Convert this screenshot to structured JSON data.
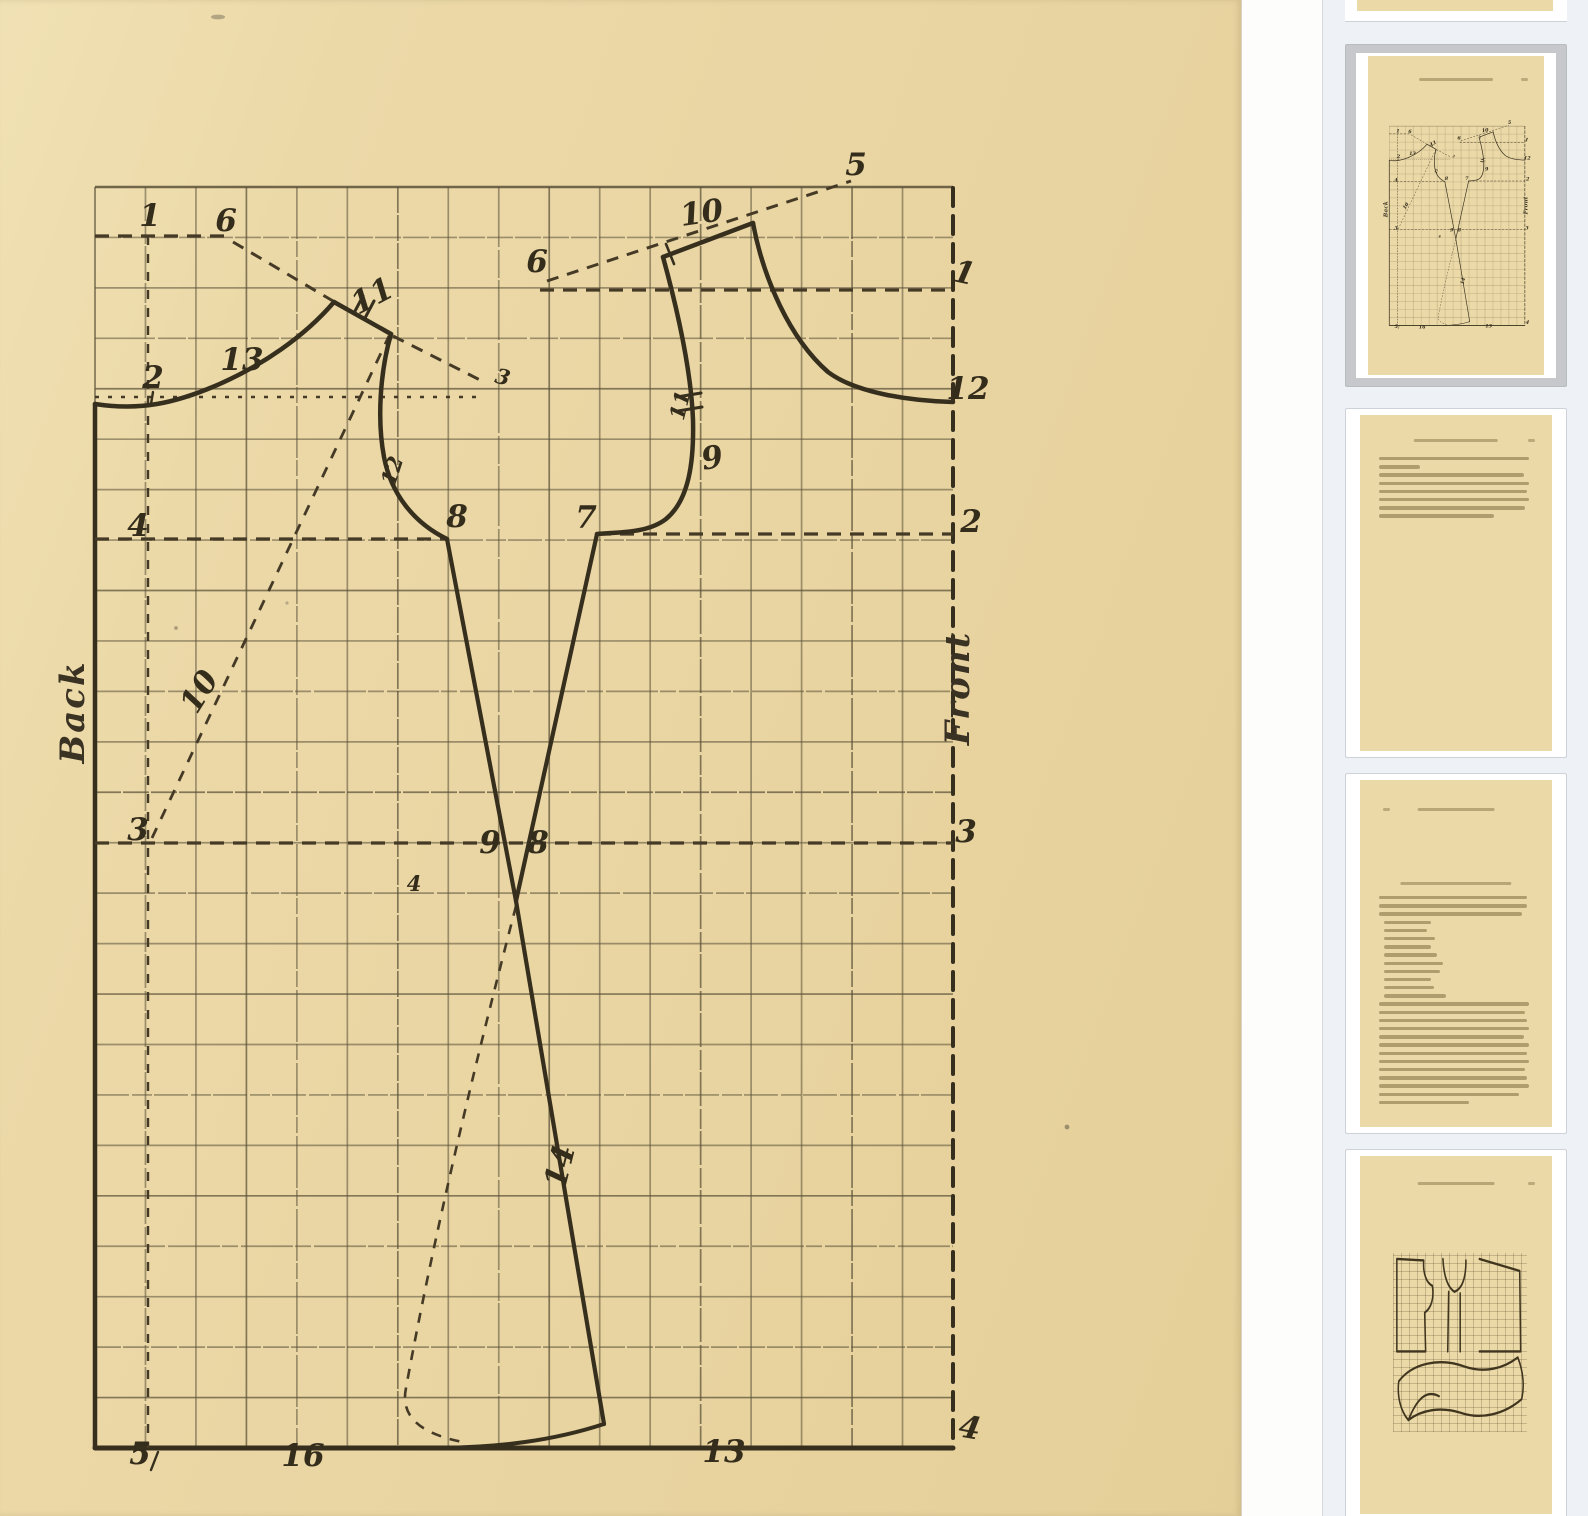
{
  "app": {
    "description": "book reader with thumbnail pane showing a garment drafting diagram page"
  },
  "main_page": {
    "side_labels": {
      "back": "Back",
      "front": "Front"
    },
    "diagram": {
      "grid": {
        "cols": 17,
        "rows": 25,
        "x0": 95,
        "y0": 187,
        "x1": 953,
        "y1": 1448
      },
      "point_labels": [
        {
          "t": "1",
          "x": 150,
          "y": 226,
          "r": 0
        },
        {
          "t": "6",
          "x": 226,
          "y": 231,
          "r": 0
        },
        {
          "t": "5",
          "x": 856,
          "y": 175,
          "r": 0
        },
        {
          "t": "10",
          "x": 703,
          "y": 223,
          "r": -8
        },
        {
          "t": "6",
          "x": 537,
          "y": 272,
          "r": 0
        },
        {
          "t": "1",
          "x": 962,
          "y": 283,
          "r": 12
        },
        {
          "t": "12",
          "x": 968,
          "y": 399,
          "r": 0
        },
        {
          "t": "13",
          "x": 242,
          "y": 370,
          "r": 0
        },
        {
          "t": "2",
          "x": 153,
          "y": 388,
          "r": 0
        },
        {
          "t": "11",
          "x": 377,
          "y": 305,
          "r": -28
        },
        {
          "t": "3",
          "x": 501,
          "y": 384,
          "r": 14,
          "small": true
        },
        {
          "t": "12",
          "x": 399,
          "y": 473,
          "r": -72,
          "small": true
        },
        {
          "t": "4",
          "x": 138,
          "y": 536,
          "r": 0
        },
        {
          "t": "8",
          "x": 457,
          "y": 527,
          "r": 0
        },
        {
          "t": "7",
          "x": 586,
          "y": 528,
          "r": 0
        },
        {
          "t": "2",
          "x": 971,
          "y": 532,
          "r": 0
        },
        {
          "t": "9",
          "x": 714,
          "y": 468,
          "r": -10
        },
        {
          "t": "11",
          "x": 687,
          "y": 407,
          "r": -76,
          "small": true
        },
        {
          "t": "10",
          "x": 208,
          "y": 697,
          "r": -58
        },
        {
          "t": "3",
          "x": 138,
          "y": 840,
          "r": 0
        },
        {
          "t": "3",
          "x": 966,
          "y": 842,
          "r": 0
        },
        {
          "t": "9",
          "x": 490,
          "y": 853,
          "r": 0
        },
        {
          "t": "8",
          "x": 538,
          "y": 853,
          "r": 0
        },
        {
          "t": "14",
          "x": 570,
          "y": 1169,
          "r": -76
        },
        {
          "t": "4",
          "x": 414,
          "y": 891,
          "r": 0,
          "small": true
        },
        {
          "t": "5",
          "x": 140,
          "y": 1464,
          "r": 0
        },
        {
          "t": "16",
          "x": 303,
          "y": 1466,
          "r": 0
        },
        {
          "t": "13",
          "x": 724,
          "y": 1462,
          "r": 0
        },
        {
          "t": "4",
          "x": 968,
          "y": 1438,
          "r": 10
        }
      ]
    }
  },
  "sidebar": {
    "thumbnails": [
      {
        "kind": "page-bottom-partial",
        "selected": false
      },
      {
        "kind": "diagram-gown-draft",
        "selected": true
      },
      {
        "kind": "text-page",
        "selected": false,
        "text_lines": [
          96,
          26,
          93,
          96,
          95,
          96,
          94,
          74
        ]
      },
      {
        "kind": "text-measurements-page",
        "selected": false,
        "para1": [
          95,
          95,
          92
        ],
        "list_lines": [
          30,
          28,
          33,
          30,
          34,
          38,
          36,
          30,
          32,
          40
        ],
        "para2": [
          96,
          94,
          95,
          96,
          93,
          96,
          95,
          96,
          94,
          95,
          96,
          90,
          58
        ]
      },
      {
        "kind": "diagram-pattern-pieces",
        "selected": false
      }
    ]
  },
  "colors": {
    "page_cream": "#ebd9a7",
    "ink": "#372f1e",
    "sidebar_bg": "#eef1f5",
    "selected_frame": "#c6c8cb",
    "card_border": "#cdd1d8"
  }
}
